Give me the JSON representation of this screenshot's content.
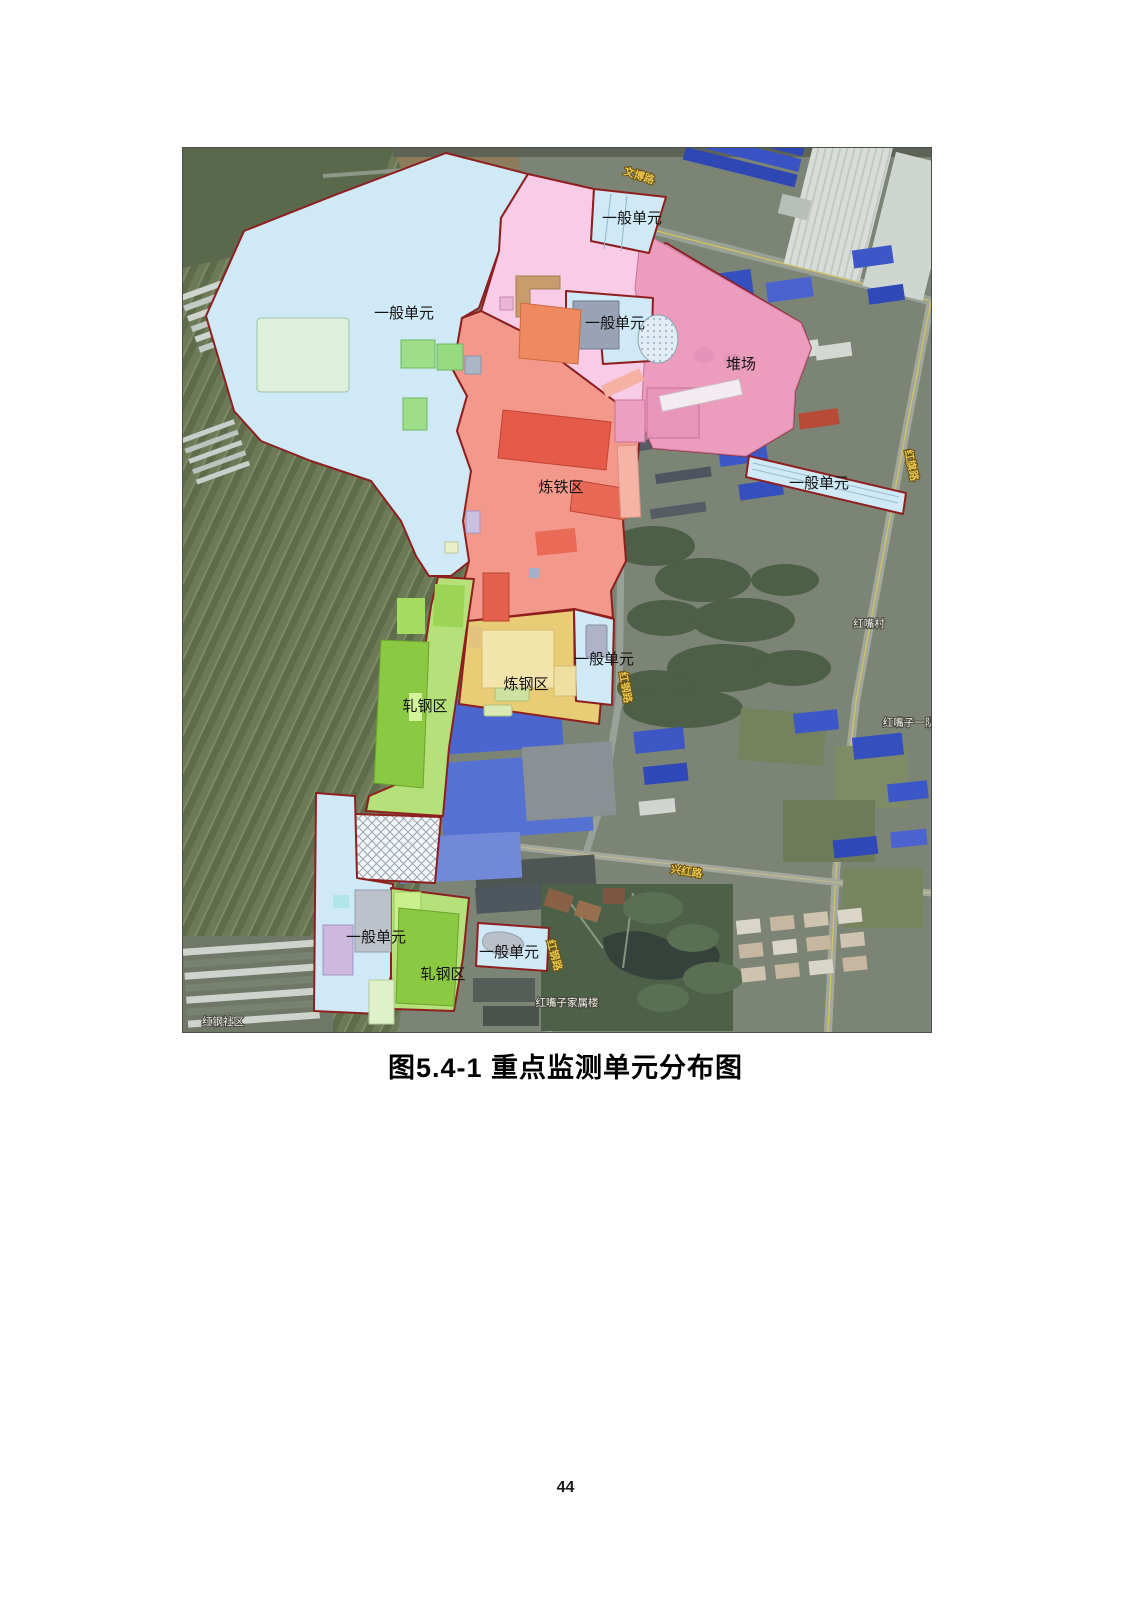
{
  "page": {
    "number": "44"
  },
  "figure": {
    "caption": "图5.4-1 重点监测单元分布图"
  },
  "map": {
    "zone_labels": {
      "general_top": "一般单元",
      "general_main": "一般单元",
      "general_mid": "一般单元",
      "yard": "堆场",
      "general_right": "一般单元",
      "iron": "炼铁区",
      "general_center": "一般单元",
      "steel": "炼钢区",
      "rolling_upper": "轧钢区",
      "general_bottom_left": "一般单元",
      "general_bottom_right": "一般单元",
      "rolling_lower": "轧钢区"
    },
    "road_labels": {
      "top": "文博路",
      "east": "红旗路",
      "center": "红钢路",
      "south": "兴红路",
      "south_center": "红钢路"
    },
    "place_labels": {
      "village": "红嘴村",
      "team": "红嘴子一队",
      "dormitory": "红嘴子家属楼",
      "community": "红钢社区"
    },
    "colors": {
      "zone_border": "#8e1f1f",
      "zone_general": "#cfe9f6",
      "zone_yard": "#f8cbe6",
      "zone_yard_dark": "#ec9dbd",
      "zone_iron": "#f2998b",
      "zone_iron_dark": "#e55a48",
      "zone_steel": "#e9cd76",
      "zone_rolling": "#b5e07a",
      "zone_rolling_dark": "#8cc943"
    }
  }
}
